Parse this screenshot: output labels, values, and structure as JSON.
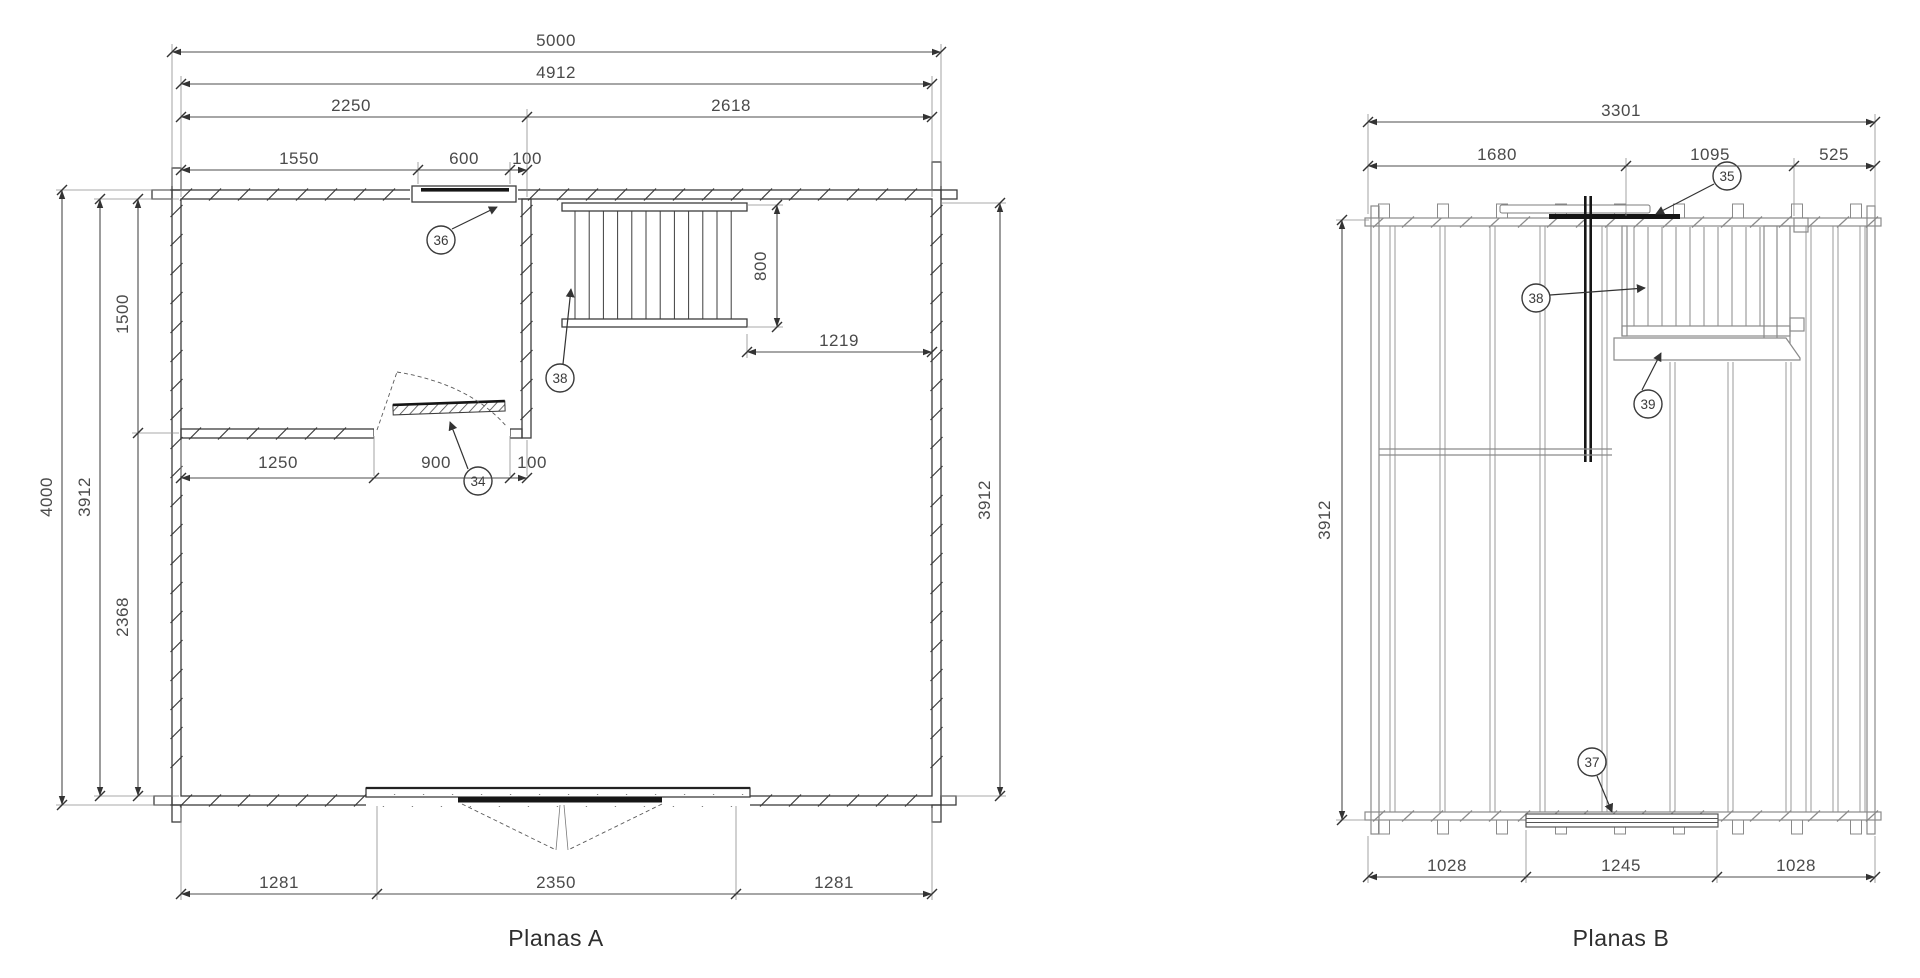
{
  "plan_a": {
    "title": "Planas A",
    "dims": {
      "overall_width": "5000",
      "inner_width": "4912",
      "room_left_width": "2250",
      "room_right_width": "2618",
      "window_offset": "1550",
      "window_width": "600",
      "window_gap": "100",
      "overall_height": "4000",
      "inner_height": "3912",
      "room_top_height": "1500",
      "room_bottom_height": "2368",
      "door_offset": "1250",
      "door_width": "900",
      "door_gap": "100",
      "stair_depth": "800",
      "stair_clear": "1219",
      "right_inner_height": "3912",
      "door_bottom_left": "1281",
      "door_bottom_width": "2350",
      "door_bottom_right": "1281"
    },
    "callouts": {
      "door": "34",
      "window": "36",
      "stairs": "38"
    }
  },
  "plan_b": {
    "title": "Planas B",
    "dims": {
      "overall_width": "3301",
      "left_section": "1680",
      "middle_section": "1095",
      "right_section": "525",
      "inner_height": "3912",
      "bottom_left": "1028",
      "bottom_middle": "1245",
      "bottom_right": "1028"
    },
    "callouts": {
      "beam": "35",
      "threshold": "37",
      "railing": "38",
      "stringer": "39"
    }
  }
}
